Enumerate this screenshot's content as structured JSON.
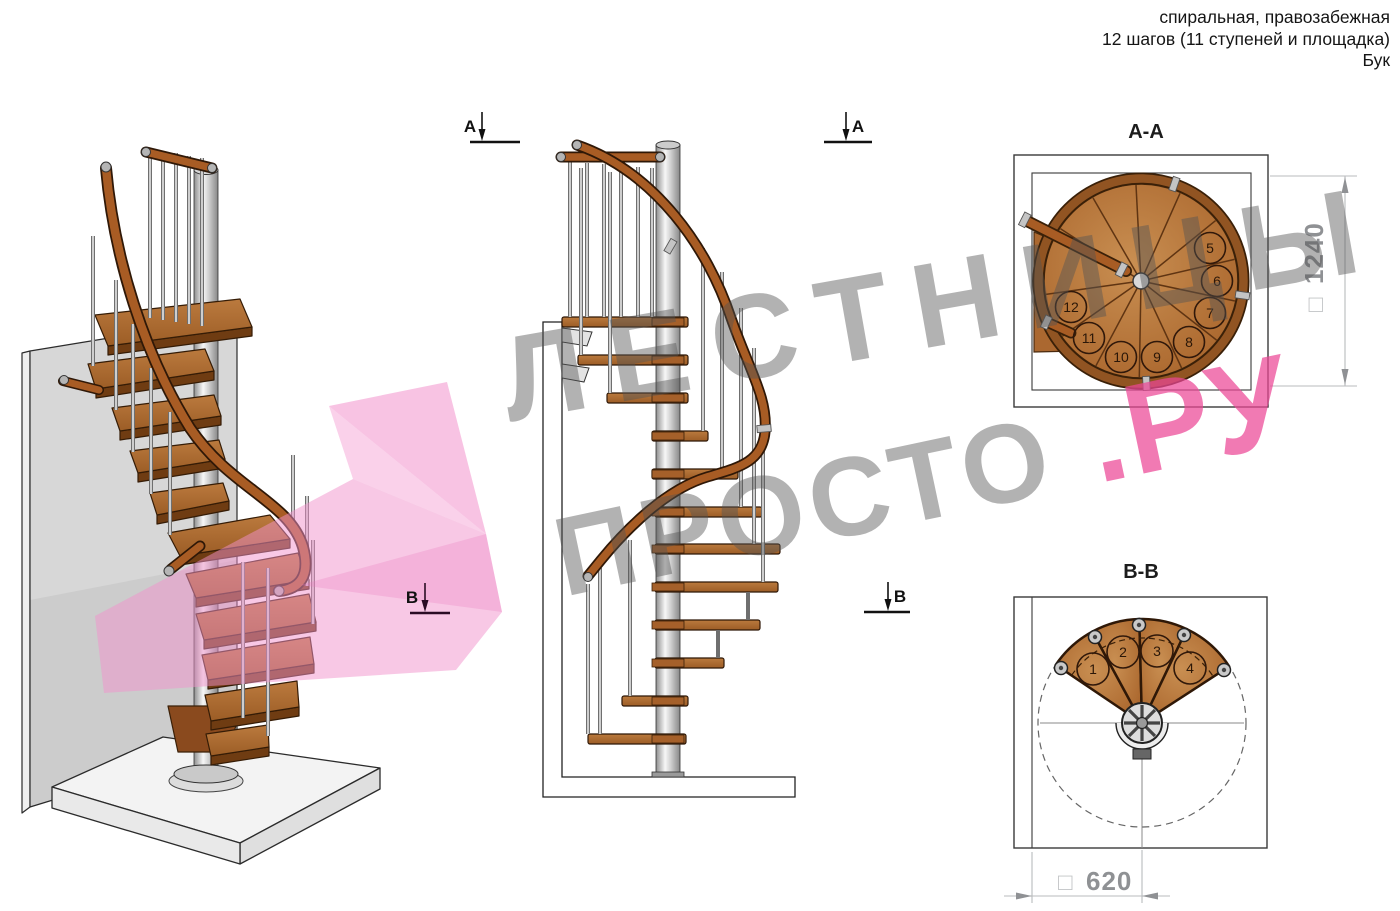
{
  "header": {
    "line1": "спиральная, правозабежная",
    "line2": "12 шагов (11 ступеней и площадка)",
    "line3": "Бук"
  },
  "sections": {
    "aa": {
      "title": "А-А",
      "dim_square": "□",
      "dim_value": "1240",
      "steps": [
        "5",
        "6",
        "7",
        "8",
        "9",
        "10",
        "11",
        "12"
      ]
    },
    "bb": {
      "title": "В-В",
      "dim_square": "□",
      "dim_value": "620",
      "steps": [
        "1",
        "2",
        "3",
        "4"
      ]
    }
  },
  "markers": {
    "a": "А",
    "b": "В"
  },
  "watermark": {
    "line1": "ЛЕСТНИЦЫ",
    "line2_gray": "ПРОСТО",
    "line2_pink": ".РУ"
  },
  "colors": {
    "wood": "#b06e34",
    "wood_dark": "#6f3c12",
    "handrail": "#a85c24",
    "pole_silver": "#cfcfcf",
    "watermark_gray": "#ababab",
    "watermark_pink": "#f07ab3",
    "dimension_gray": "#8f9194"
  }
}
